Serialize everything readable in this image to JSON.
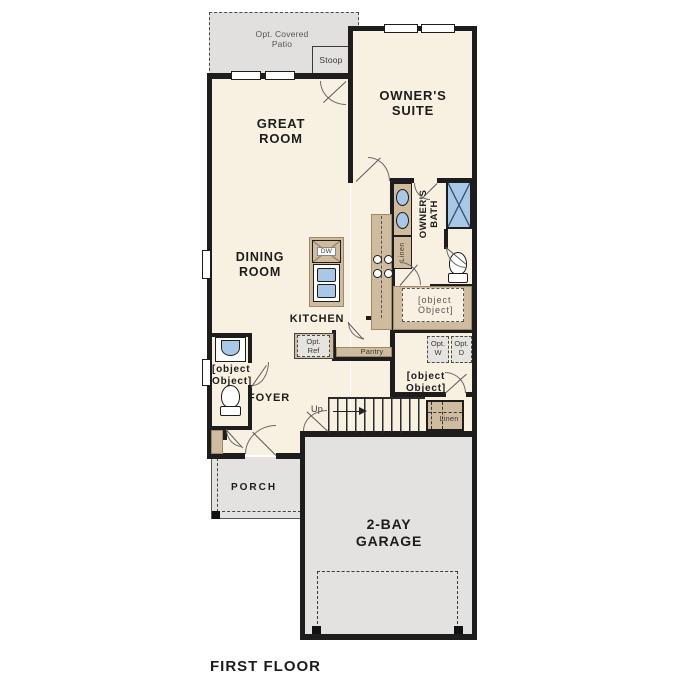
{
  "footer": {
    "title": "FIRST FLOOR"
  },
  "colors": {
    "floor": "#f8f1e2",
    "surface_gray": "#e3e2e0",
    "cabinet_tan": "#cfbb9d",
    "fixture_blue": "#a9c7e6",
    "wall": "#1d1d1d"
  },
  "rooms": {
    "patio": {
      "l1": "Opt. Covered",
      "l2": "Patio"
    },
    "stoop": {
      "l1": "Stoop"
    },
    "great_room": {
      "l1": "GREAT",
      "l2": "ROOM"
    },
    "owners_suite": {
      "l1": "OWNER'S",
      "l2": "SUITE"
    },
    "owners_bath": {
      "l1": "OWNER'S",
      "l2": "BATH"
    },
    "dining_room": {
      "l1": "DINING",
      "l2": "ROOM"
    },
    "kitchen": {
      "l1": "KITCHEN"
    },
    "wic": {
      "l1": "WIC"
    },
    "laundry": {
      "l1": "LAUNDRY"
    },
    "pwdr": {
      "l1": "PWDR"
    },
    "foyer": {
      "l1": "FOYER"
    },
    "porch": {
      "l1": "PORCH"
    },
    "garage": {
      "l1": "2-BAY",
      "l2": "GARAGE"
    }
  },
  "fixtures": {
    "dw": "DW",
    "pantry": "Pantry",
    "linen_bath": "Linen",
    "linen_hall": "Linen",
    "opt_ref": {
      "l1": "Opt.",
      "l2": "Ref"
    },
    "opt_w": {
      "l1": "Opt.",
      "l2": "W"
    },
    "opt_d": {
      "l1": "Opt.",
      "l2": "D"
    },
    "up": "Up"
  }
}
